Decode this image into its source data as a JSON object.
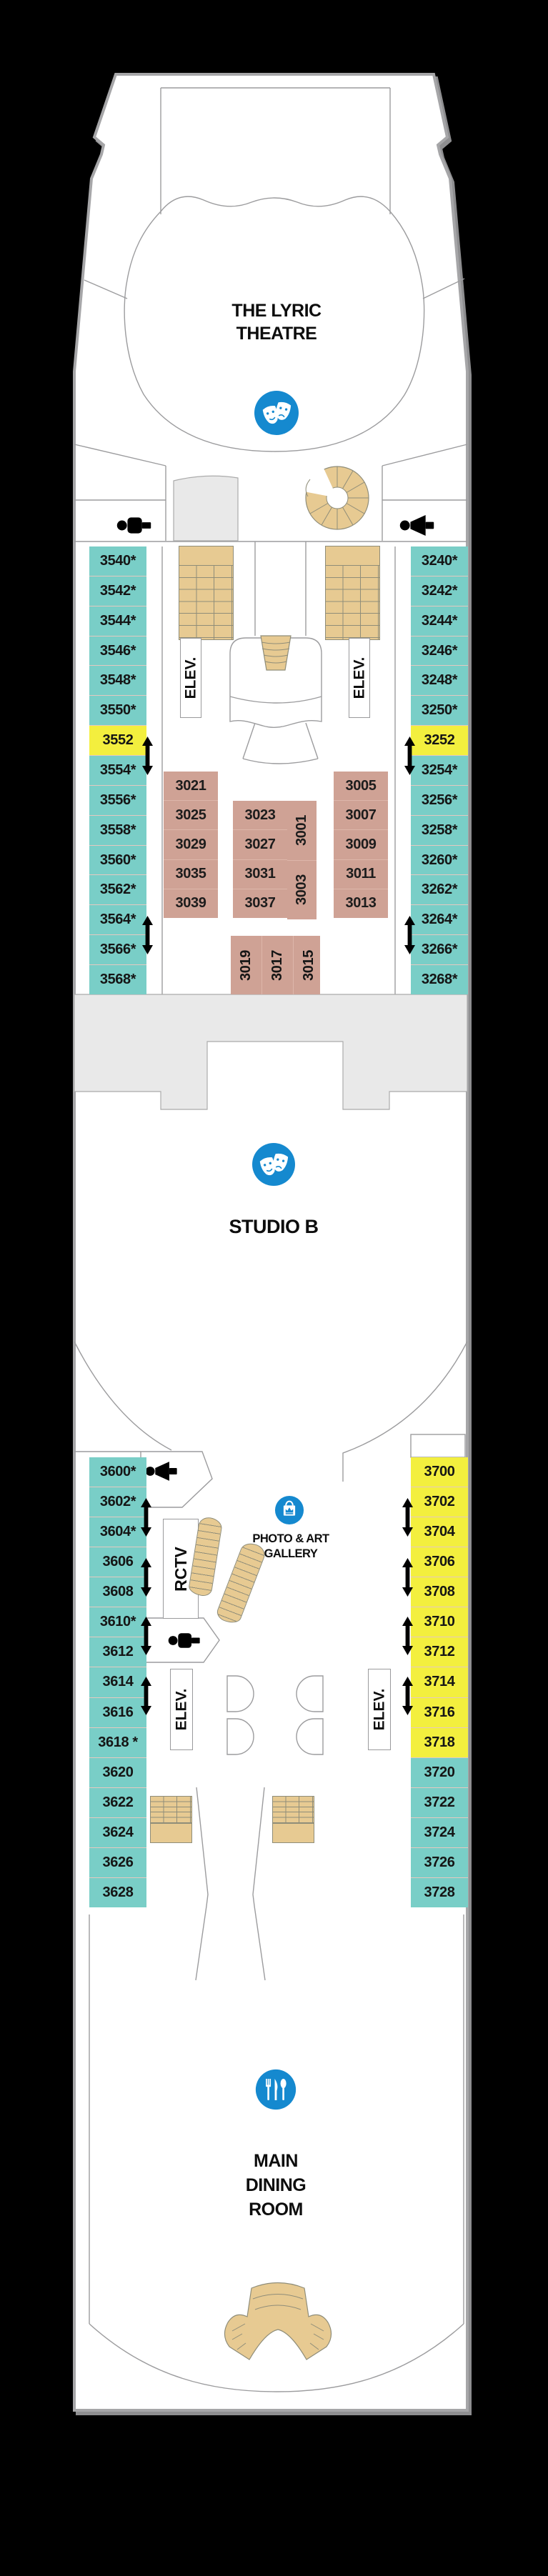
{
  "deck": {
    "venues": {
      "theatre_lines": [
        "THE LYRIC",
        "THEATRE"
      ],
      "studio": "STUDIO B",
      "gallery_lines": [
        "PHOTO & ART",
        "GALLERY"
      ],
      "dining_lines": [
        "MAIN",
        "DINING",
        "ROOM"
      ]
    },
    "labels": {
      "elevator": "ELEV.",
      "rctv": "RCTV"
    },
    "cabins": {
      "port_upper": [
        "3540*",
        "3542*",
        "3544*",
        "3546*",
        "3548*",
        "3550*",
        "3552",
        "3554*",
        "3556*",
        "3558*",
        "3560*",
        "3562*",
        "3564*",
        "3566*",
        "3568*"
      ],
      "stbd_upper": [
        "3240*",
        "3242*",
        "3244*",
        "3246*",
        "3248*",
        "3250*",
        "3252",
        "3254*",
        "3256*",
        "3258*",
        "3260*",
        "3262*",
        "3264*",
        "3266*",
        "3268*"
      ],
      "center_col_a": [
        "3021",
        "3025",
        "3029",
        "3035",
        "3039"
      ],
      "center_col_b": [
        "3023",
        "3027",
        "3031",
        "3037"
      ],
      "center_col_c": [
        "3001",
        "3003"
      ],
      "center_col_d": [
        "3005",
        "3007",
        "3009",
        "3011",
        "3013"
      ],
      "center_col_e": [
        "3019",
        "3017",
        "3015"
      ],
      "port_lower": [
        "3600*",
        "3602*",
        "3604*",
        "3606",
        "3608",
        "3610*",
        "3612",
        "3614",
        "3616",
        "3618 *",
        "3620",
        "3622",
        "3624",
        "3626",
        "3628"
      ],
      "stbd_lower": [
        "3700",
        "3702",
        "3704",
        "3706",
        "3708",
        "3710",
        "3712",
        "3714",
        "3716",
        "3718",
        "3720",
        "3722",
        "3724",
        "3726",
        "3728"
      ]
    },
    "icons": {
      "theatre": "comedy-tragedy-masks",
      "studio": "comedy-tragedy-masks",
      "gallery": "shopping-bag-with-crown",
      "dining": "fork-knife-spoon",
      "restrooms": [
        "men",
        "women",
        "women",
        "men"
      ],
      "stairs": "tan-staircase",
      "arrows": "deck-connection-double-arrow"
    }
  },
  "theme": {
    "teal": "#79CEC7",
    "yellow": "#F3EF3E",
    "cabin": "#CFA295",
    "sep": "#E5C9C0",
    "csep": "#DDB6AA",
    "stair": "#E7CA92",
    "stairline": "#8F8D79",
    "blue": "#1589CF",
    "gray": "#E9E9E9"
  }
}
